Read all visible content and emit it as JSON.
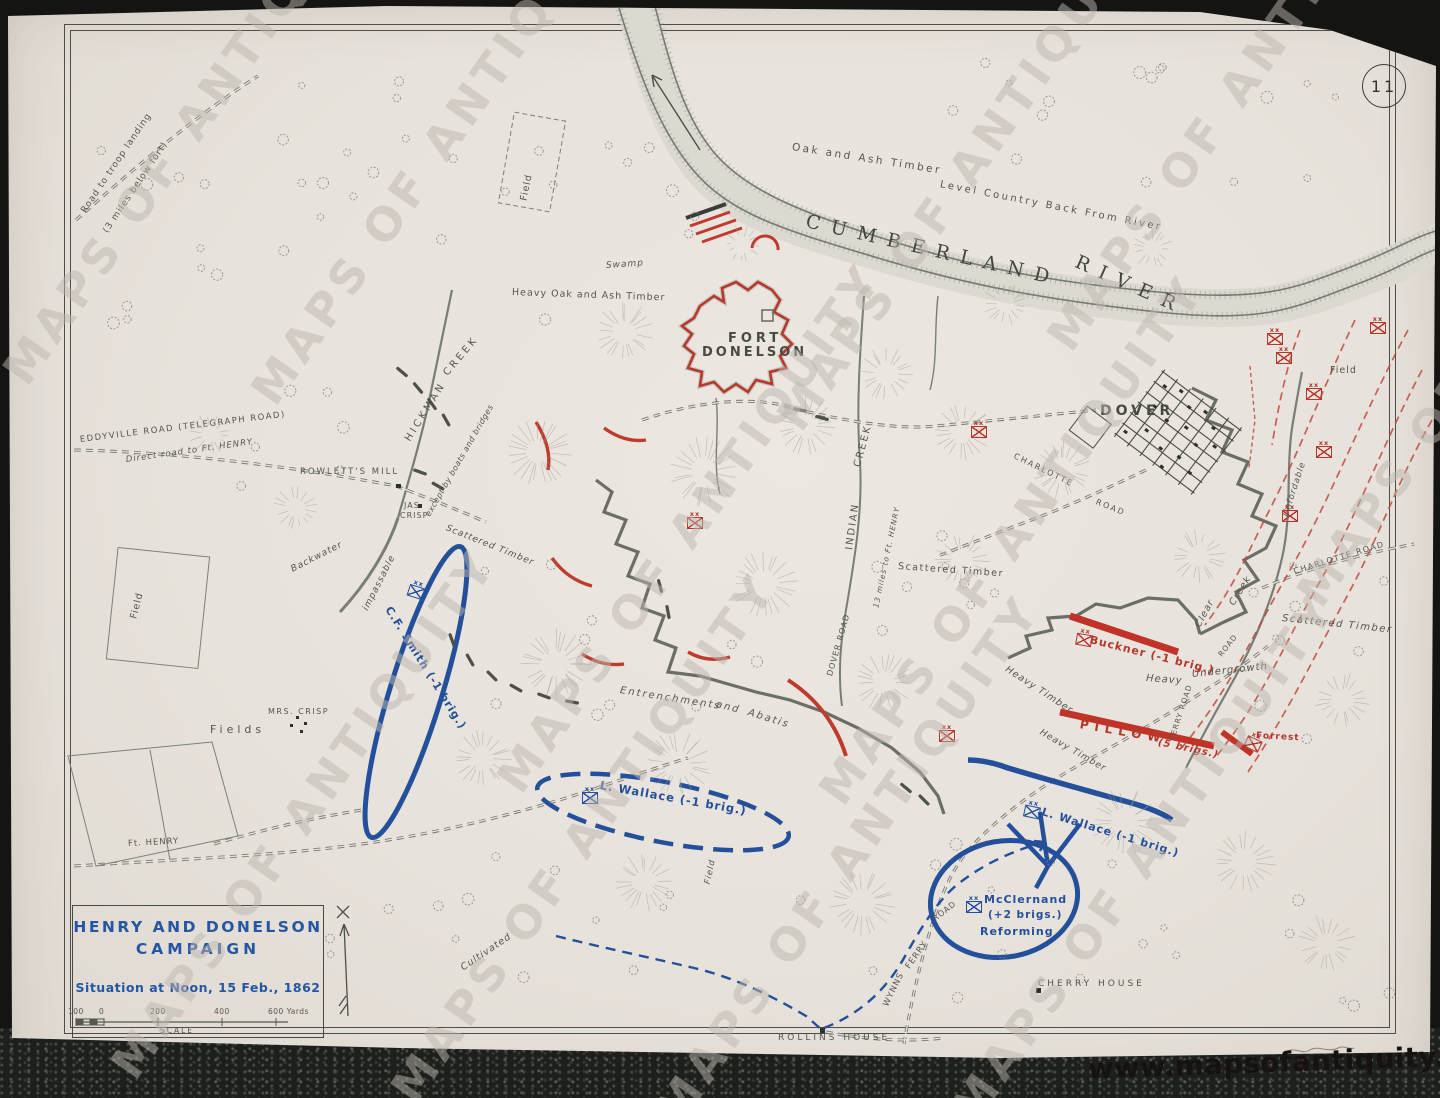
{
  "page": {
    "number": "11",
    "url": "www.mapsofantiquity.com",
    "watermark": "MAPS OF ANTIQUITY"
  },
  "title_block": {
    "line1": "HENRY AND DONELSON",
    "line2": "CAMPAIGN",
    "subtitle": "Situation at Noon, 15 Feb., 1862",
    "scale_label": "SCALE",
    "scale_ticks": [
      "100",
      "0",
      "200",
      "400",
      "600 Yards"
    ]
  },
  "map": {
    "unit_symbol_echelon": "xx",
    "labels": [
      {
        "t": "Road to troop landing",
        "x": 84,
        "y": 208,
        "r": -56,
        "s": 9,
        "n": "label-road-troop-landing"
      },
      {
        "t": "(3 miles below fort)",
        "x": 106,
        "y": 228,
        "r": -56,
        "s": 9
      },
      {
        "t": "Oak and Ash Timber",
        "x": 792,
        "y": 142,
        "r": 9,
        "s": 10.5,
        "ls": 2.5,
        "n": "label-oak-ash-timber"
      },
      {
        "t": "Level Country Back From River",
        "x": 940,
        "y": 180,
        "r": 11,
        "s": 10,
        "ls": 2.5,
        "n": "label-level-country"
      },
      {
        "t": "CUMBERLAND",
        "x": 806,
        "y": 212,
        "r": 13,
        "s": 19,
        "ls": 11,
        "c": "serif",
        "n": "label-cumberland-river"
      },
      {
        "t": "RIVER",
        "x": 1076,
        "y": 252,
        "r": 24,
        "s": 19,
        "ls": 11,
        "c": "serif"
      },
      {
        "t": "Field",
        "x": 524,
        "y": 196,
        "r": -78,
        "s": 9.5
      },
      {
        "t": "Swamp",
        "x": 606,
        "y": 262,
        "r": -4,
        "s": 9,
        "i": 1
      },
      {
        "t": "Heavy Oak and Ash Timber",
        "x": 512,
        "y": 288,
        "r": 2,
        "s": 9.5
      },
      {
        "t": "FORT",
        "x": 728,
        "y": 332,
        "s": 13,
        "ls": 4,
        "c": "fort",
        "n": "label-fort-donelson"
      },
      {
        "t": "DONELSON",
        "x": 702,
        "y": 346,
        "s": 13,
        "ls": 3,
        "c": "fort"
      },
      {
        "t": "DOVER",
        "x": 1100,
        "y": 404,
        "s": 14,
        "ls": 4,
        "c": "fort",
        "n": "label-dover"
      },
      {
        "t": "HICKMAN",
        "x": 408,
        "y": 436,
        "r": -58,
        "s": 10,
        "ls": 3,
        "n": "label-hickman-creek"
      },
      {
        "t": "CREEK",
        "x": 446,
        "y": 370,
        "r": -50,
        "s": 10,
        "ls": 3
      },
      {
        "t": "except by boats and bridges",
        "x": 428,
        "y": 512,
        "r": -60,
        "s": 8,
        "ls": 0.5,
        "i": 1
      },
      {
        "t": "Backwater",
        "x": 292,
        "y": 566,
        "r": -27,
        "s": 9,
        "i": 1
      },
      {
        "t": "impassable",
        "x": 366,
        "y": 606,
        "r": -63,
        "s": 9,
        "i": 1
      },
      {
        "t": "EDDYVILLE ROAD  (TELEGRAPH ROAD)",
        "x": 80,
        "y": 436,
        "r": -7,
        "s": 8.5,
        "ls": 1.5,
        "n": "label-eddyville-road"
      },
      {
        "t": "Direct road to Ft. HENRY",
        "x": 126,
        "y": 456,
        "r": -8,
        "s": 8.5,
        "i": 1
      },
      {
        "t": "ROWLETT'S  MILL",
        "x": 300,
        "y": 468,
        "s": 8.5,
        "ls": 2,
        "n": "label-rowletts-mill"
      },
      {
        "t": "JAS.",
        "x": 404,
        "y": 502,
        "s": 8
      },
      {
        "t": "CRISP",
        "x": 400,
        "y": 512,
        "s": 8
      },
      {
        "t": "Scattered Timber",
        "x": 446,
        "y": 524,
        "r": 22,
        "s": 9,
        "i": 1
      },
      {
        "t": "MRS. CRISP",
        "x": 268,
        "y": 708,
        "s": 8,
        "ls": 1.5
      },
      {
        "t": "Fields",
        "x": 210,
        "y": 724,
        "s": 11,
        "ls": 4
      },
      {
        "t": "Field",
        "x": 134,
        "y": 614,
        "r": -76,
        "s": 9.5
      },
      {
        "t": "Ft. HENRY",
        "x": 128,
        "y": 840,
        "r": -3,
        "s": 8.5,
        "n": "label-ft-henry-road"
      },
      {
        "t": "Entrenchments",
        "x": 620,
        "y": 686,
        "r": 9,
        "s": 10,
        "ls": 2,
        "i": 1,
        "n": "label-entrenchments"
      },
      {
        "t": "and",
        "x": 716,
        "y": 700,
        "r": 14,
        "s": 10,
        "ls": 2,
        "i": 1
      },
      {
        "t": "Abatis",
        "x": 748,
        "y": 708,
        "r": 17,
        "s": 10,
        "ls": 2,
        "i": 1
      },
      {
        "t": "Cultivated",
        "x": 462,
        "y": 964,
        "r": -34,
        "s": 9.5,
        "i": 1
      },
      {
        "t": "INDIAN",
        "x": 850,
        "y": 545,
        "r": -82,
        "s": 10,
        "ls": 2,
        "n": "label-indian-creek"
      },
      {
        "t": "CREEK",
        "x": 858,
        "y": 462,
        "r": -75,
        "s": 10,
        "ls": 2
      },
      {
        "t": "13 miles to Ft. HENRY",
        "x": 876,
        "y": 604,
        "r": -78,
        "s": 7.5,
        "i": 1
      },
      {
        "t": "DOVER ROAD",
        "x": 830,
        "y": 672,
        "r": -74,
        "s": 8
      },
      {
        "t": "Scattered Timber",
        "x": 898,
        "y": 562,
        "r": 4,
        "s": 9.5,
        "ls": 1.5
      },
      {
        "t": "Heavy Timber",
        "x": 1006,
        "y": 664,
        "r": 33,
        "s": 9.5,
        "i": 1
      },
      {
        "t": "Heavy",
        "x": 1146,
        "y": 674,
        "r": 4,
        "s": 10,
        "i": 1
      },
      {
        "t": "Undergrowth",
        "x": 1192,
        "y": 670,
        "r": -6,
        "s": 10,
        "i": 1
      },
      {
        "t": "Heavy Timber",
        "x": 1040,
        "y": 728,
        "r": 30,
        "s": 9,
        "i": 1
      },
      {
        "t": "Clear",
        "x": 1198,
        "y": 622,
        "r": -62,
        "s": 9.5,
        "i": 1
      },
      {
        "t": "Creek",
        "x": 1232,
        "y": 600,
        "r": -58,
        "s": 9.5,
        "i": 1
      },
      {
        "t": "Unfordable",
        "x": 1286,
        "y": 512,
        "r": -72,
        "s": 8.5,
        "i": 1
      },
      {
        "t": "Field",
        "x": 1330,
        "y": 366,
        "s": 9.5
      },
      {
        "t": "CHARLOTTE",
        "x": 1014,
        "y": 452,
        "r": 26,
        "s": 8,
        "ls": 2,
        "n": "label-charlotte-road"
      },
      {
        "t": "ROAD",
        "x": 1096,
        "y": 498,
        "r": 22,
        "s": 8,
        "ls": 2
      },
      {
        "t": "CHARLOTTE  ROAD",
        "x": 1294,
        "y": 568,
        "r": -17,
        "s": 8,
        "ls": 1.5
      },
      {
        "t": "Scattered Timber",
        "x": 1282,
        "y": 614,
        "r": 6,
        "s": 10,
        "ls": 1.5,
        "i": 1
      },
      {
        "t": "ROAD",
        "x": 1220,
        "y": 652,
        "r": -52,
        "s": 7.5
      },
      {
        "t": "FERRY ROAD",
        "x": 1172,
        "y": 736,
        "r": -72,
        "s": 7.5
      },
      {
        "t": "WYNNS",
        "x": 886,
        "y": 1002,
        "r": -64,
        "s": 8.5,
        "n": "label-wynns-ferry-road"
      },
      {
        "t": "FERRY",
        "x": 908,
        "y": 964,
        "r": -55,
        "s": 8.5
      },
      {
        "t": "ROAD",
        "x": 934,
        "y": 916,
        "r": -38,
        "s": 8
      },
      {
        "t": "ROLLINS  HOUSE",
        "x": 778,
        "y": 1034,
        "s": 9,
        "ls": 3,
        "n": "label-rollins-house"
      },
      {
        "t": "CHERRY  HOUSE",
        "x": 1038,
        "y": 980,
        "s": 9,
        "ls": 3,
        "n": "label-cherry-house"
      },
      {
        "t": "Field",
        "x": 708,
        "y": 880,
        "r": -78,
        "s": 8.5,
        "i": 1
      },
      {
        "t": "C.F. Smith (-1 brig.)",
        "x": 388,
        "y": 602,
        "r": 58,
        "s": 11,
        "c": "blue",
        "n": "label-cf-smith"
      },
      {
        "t": "L. Wallace (-1 brig.)",
        "x": 600,
        "y": 780,
        "r": 10,
        "s": 11.5,
        "c": "blue",
        "n": "label-l-wallace-left"
      },
      {
        "t": "McClernand",
        "x": 984,
        "y": 894,
        "s": 11,
        "c": "blue",
        "n": "label-mcclernand"
      },
      {
        "t": "(+2 brigs.)",
        "x": 988,
        "y": 910,
        "s": 10.5,
        "c": "blue"
      },
      {
        "t": "Reforming",
        "x": 980,
        "y": 926,
        "s": 11,
        "c": "blue"
      },
      {
        "t": "L. Wallace (-1 brig.)",
        "x": 1042,
        "y": 806,
        "r": 17,
        "s": 11,
        "c": "blue",
        "n": "label-l-wallace-right"
      },
      {
        "t": "Buckner (-1 brig.)",
        "x": 1090,
        "y": 634,
        "r": 14,
        "s": 11,
        "c": "red",
        "n": "label-buckner"
      },
      {
        "t": "PILLOW",
        "x": 1080,
        "y": 718,
        "r": 10,
        "s": 12,
        "ls": 6,
        "c": "red",
        "n": "label-pillow"
      },
      {
        "t": "(5 brigs.)",
        "x": 1158,
        "y": 738,
        "r": 12,
        "s": 10,
        "c": "red",
        "i": 1
      },
      {
        "t": "Forrest",
        "x": 1256,
        "y": 732,
        "r": 3,
        "s": 9,
        "c": "red",
        "n": "label-forrest"
      }
    ],
    "unit_symbols": [
      {
        "x": 408,
        "y": 586,
        "r": 18,
        "side": "union"
      },
      {
        "x": 582,
        "y": 792,
        "side": "union"
      },
      {
        "x": 966,
        "y": 901,
        "side": "union"
      },
      {
        "x": 1024,
        "y": 806,
        "r": 12,
        "side": "union"
      },
      {
        "x": 1076,
        "y": 634,
        "r": 10,
        "side": "conf"
      },
      {
        "x": 1245,
        "y": 738,
        "r": 25,
        "side": "conf"
      },
      {
        "x": 1276,
        "y": 352,
        "side": "conf"
      },
      {
        "x": 1306,
        "y": 388,
        "side": "conf"
      },
      {
        "x": 1316,
        "y": 446,
        "side": "conf"
      },
      {
        "x": 1282,
        "y": 510,
        "side": "conf"
      },
      {
        "x": 1267,
        "y": 333,
        "side": "conf"
      },
      {
        "x": 971,
        "y": 426,
        "side": "conf"
      },
      {
        "x": 687,
        "y": 517,
        "side": "conf"
      },
      {
        "x": 939,
        "y": 730,
        "side": "conf"
      },
      {
        "x": 1370,
        "y": 322,
        "side": "conf"
      }
    ]
  }
}
